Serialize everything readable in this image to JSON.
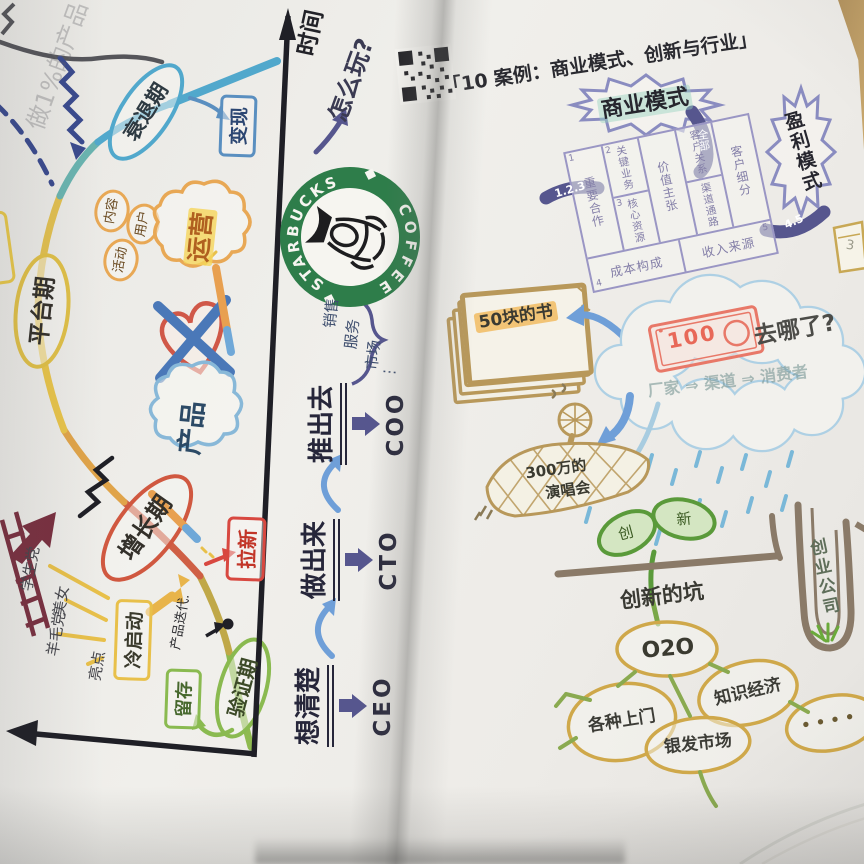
{
  "palette": {
    "paper": "#efeeea",
    "ink": "#2a2a30",
    "starbucks_green": "#2e7d4a",
    "highlight_yellow": "#f5d860",
    "canvas_purple": "#9a96c4",
    "sketch_tan": "#b8985a",
    "sky_blue": "#6f9fd8",
    "lifecycle_red": "#d05840"
  },
  "left_page": {
    "faded_note": "做1%的产品",
    "time_label": "时间",
    "play_question": "怎么玩?",
    "monetize": "变现",
    "stages": {
      "decline": "衰退期",
      "platform": "平台期",
      "growth": "增长期",
      "validation": "验证期"
    },
    "ops_label": "运营",
    "bubbles": [
      "内容",
      "用户",
      "活动"
    ],
    "product_label": "产品",
    "steps": [
      {
        "label": "想清楚",
        "role": "CEO"
      },
      {
        "label": "做出来",
        "role": "CTO"
      },
      {
        "label": "推出去",
        "role": "COO"
      }
    ],
    "coo_scope": [
      "销售",
      "服务",
      "市场",
      "⋮"
    ],
    "pull_new": "拉新",
    "cold_start": "冷启动",
    "cold_sources": [
      "学生党",
      "美女",
      "羊毛党",
      "亮点"
    ],
    "iteration": "产品迭代.",
    "retention": "留存",
    "starbucks": {
      "top": "STARBUCKS",
      "bottom": "COFFEE"
    }
  },
  "right_page": {
    "header": "「10 案例：商业模式、创新与行业」",
    "business_model": "商业模式",
    "ribbon": "全部",
    "profit_model": "盈利模式",
    "band_left": "1.2.3",
    "band_right": "4.5",
    "canvas": {
      "partners": "重要合作",
      "activities": "关键业务",
      "resources": "核心资源",
      "value": "价值主张",
      "relations": "客户关系",
      "channels": "渠道通路",
      "segments": "客户细分",
      "costs": "成本构成",
      "revenue": "收入来源",
      "nums": [
        "1",
        "2",
        "3",
        "4",
        "5"
      ]
    },
    "paper_note": "3",
    "book_label": "50块的书",
    "bill": "100",
    "where_question": "去哪了?",
    "chain": "厂家 ⇒ 渠道 ⇒ 消费者",
    "concert_line1": "300万的",
    "concert_line2": "演唱会",
    "leaf_left": "创",
    "leaf_right": "新",
    "innovation_pit": "创新的坑",
    "root_node": "O2O",
    "branches": [
      "各种上门",
      "知识经济",
      "银发市场",
      "• • • •"
    ],
    "startup_pit": "创业公司"
  }
}
